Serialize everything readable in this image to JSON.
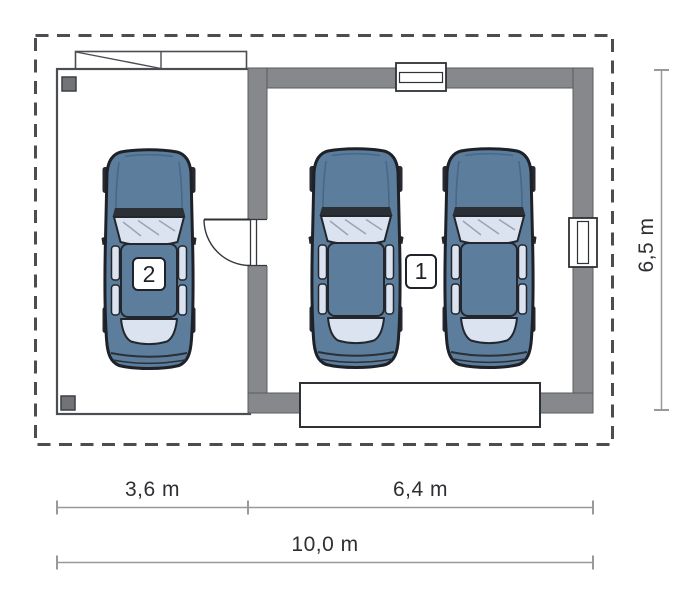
{
  "room_labels": {
    "garage": "1",
    "carport": "2"
  },
  "dimensions": {
    "carport_width": "3,6 m",
    "garage_width": "6,4 m",
    "total_width": "10,0 m",
    "building_depth": "6,5 m"
  },
  "icons": {
    "cars": [
      "car-top-view",
      "car-top-view",
      "car-top-view"
    ],
    "openings": [
      "window",
      "window",
      "door-swing",
      "garage-door"
    ],
    "structure": [
      "column-post",
      "column-post",
      "roof-overhang",
      "site-boundary-dashed"
    ]
  },
  "colors": {
    "wall_fill": "#86888b",
    "wall_edge": "#595b5e",
    "car_body": "#5c7e9c",
    "car_glass": "#dbe3f1",
    "car_outline": "#1e2228",
    "boundary_dash": "#4b4d50",
    "dimension_line": "#97999c",
    "dimension_text": "#2d2f33",
    "background": "#ffffff"
  }
}
